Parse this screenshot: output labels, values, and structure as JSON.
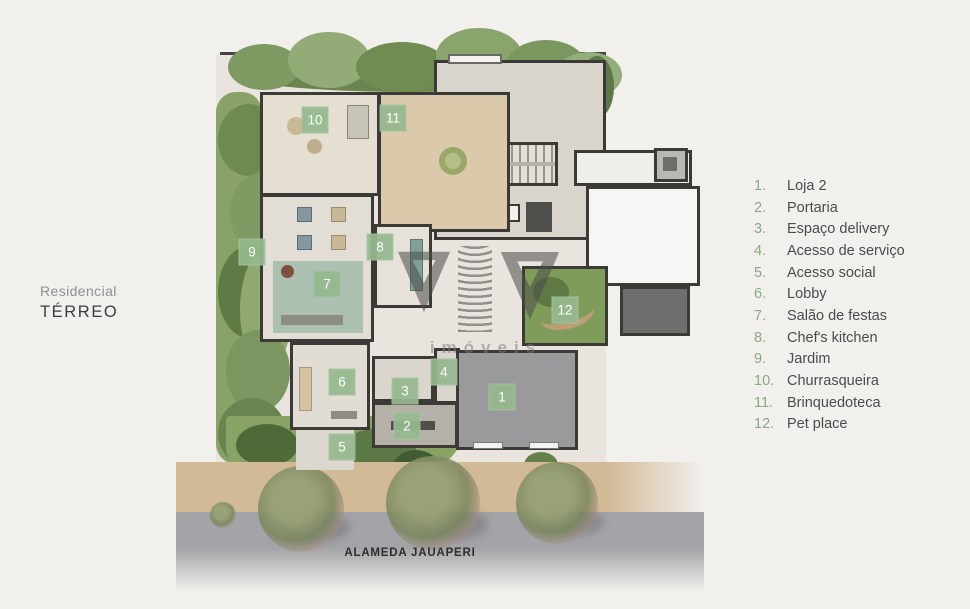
{
  "title": {
    "line1": "Residencial",
    "line2": "TÉRREO"
  },
  "street_label": "ALAMEDA JAUAPERI",
  "watermark_text": "imóveis",
  "legend": {
    "items": [
      {
        "num": "1.",
        "label": "Loja 2"
      },
      {
        "num": "2.",
        "label": "Portaria"
      },
      {
        "num": "3.",
        "label": "Espaço delivery"
      },
      {
        "num": "4.",
        "label": "Acesso de serviço"
      },
      {
        "num": "5.",
        "label": "Acesso social"
      },
      {
        "num": "6.",
        "label": "Lobby"
      },
      {
        "num": "7.",
        "label": "Salão de festas"
      },
      {
        "num": "8.",
        "label": "Chef's kitchen"
      },
      {
        "num": "9.",
        "label": "Jardim"
      },
      {
        "num": "10.",
        "label": "Churrasqueira"
      },
      {
        "num": "11.",
        "label": "Brinquedoteca"
      },
      {
        "num": "12.",
        "label": "Pet place"
      }
    ]
  },
  "badges": [
    {
      "n": "1"
    },
    {
      "n": "2"
    },
    {
      "n": "3"
    },
    {
      "n": "4"
    },
    {
      "n": "5"
    },
    {
      "n": "6"
    },
    {
      "n": "7"
    },
    {
      "n": "8"
    },
    {
      "n": "9"
    },
    {
      "n": "10"
    },
    {
      "n": "11"
    },
    {
      "n": "12"
    }
  ],
  "colors": {
    "badge_green": "#96b88e",
    "legend_number_green": "#8aa884",
    "wall_dark": "#3b3a36",
    "lawn_green": "#7f9c5b",
    "street_gray": "#a0a0a4",
    "sidewalk_tan": "#d3ba97"
  }
}
